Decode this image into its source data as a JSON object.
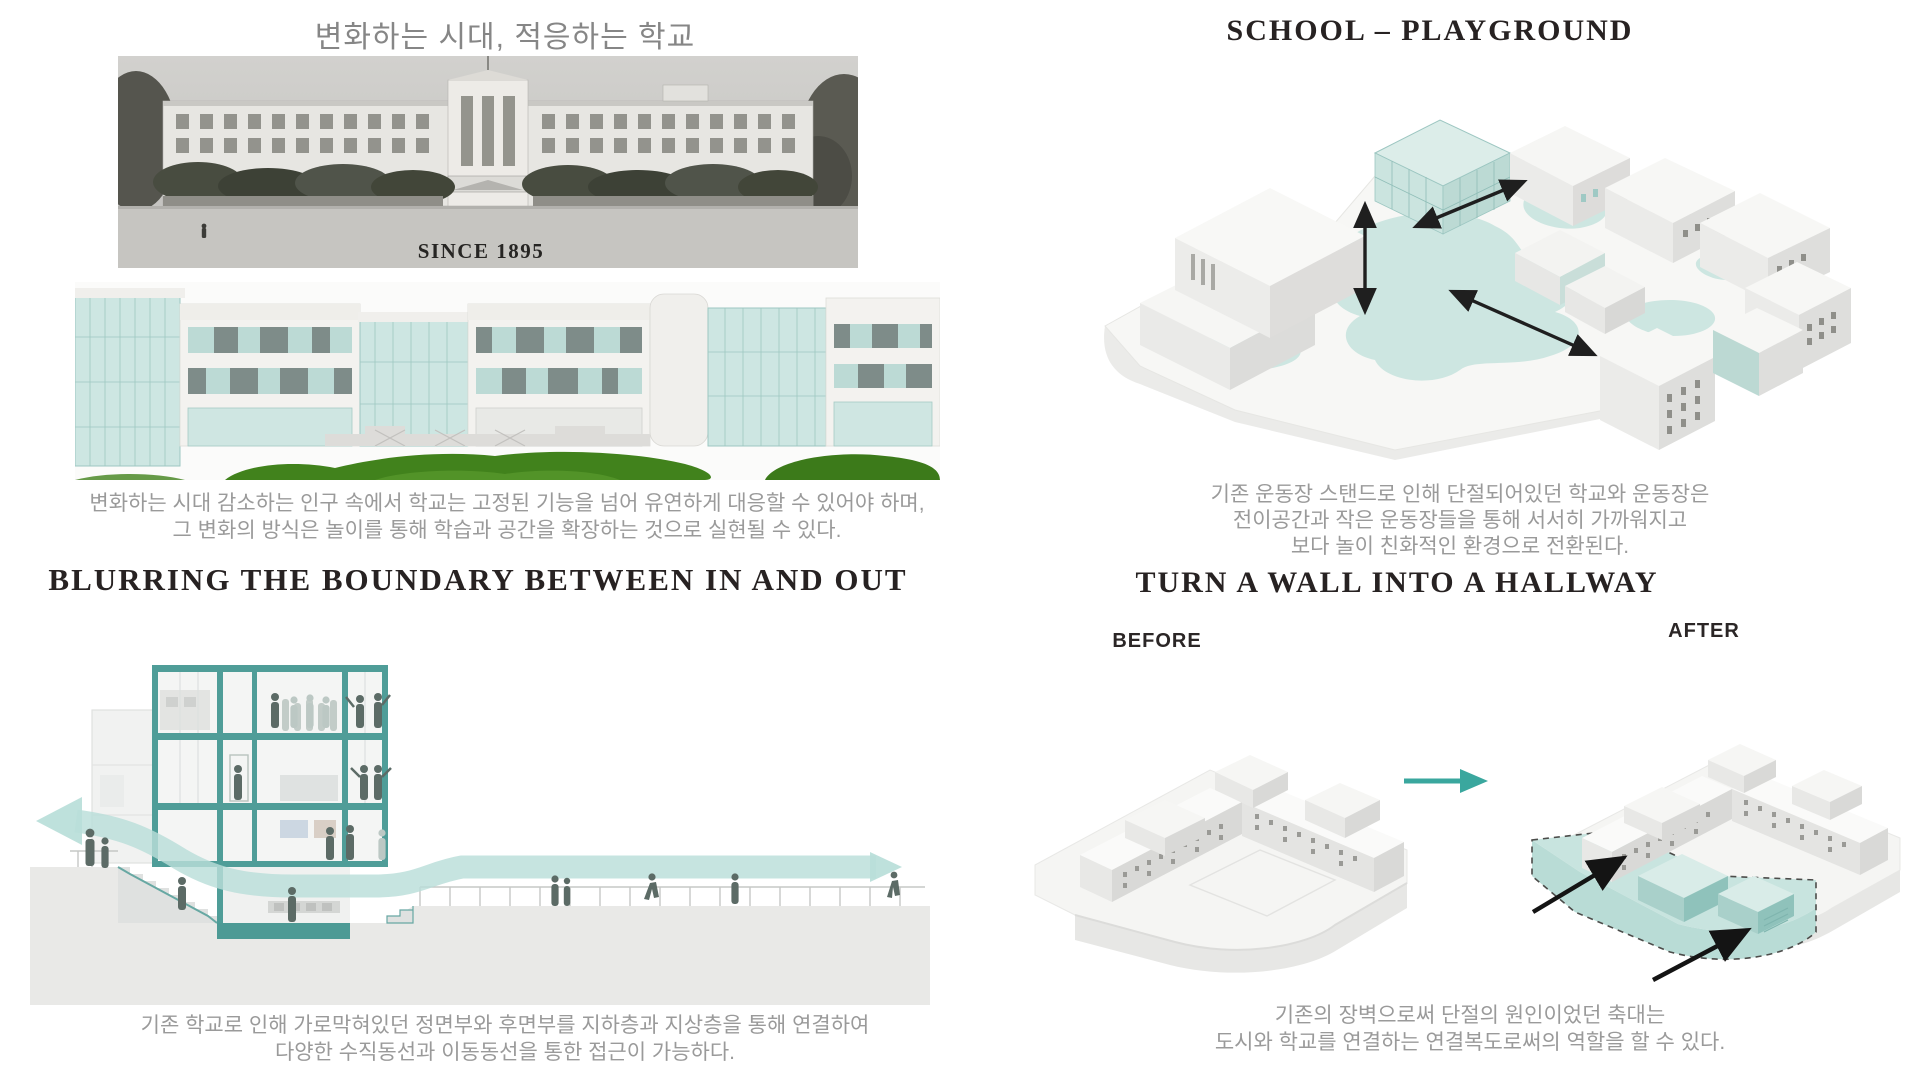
{
  "colors": {
    "teal_accent": "#4f9d98",
    "teal_glass": "#cde6e2",
    "teal_band": "#b9ded9",
    "teal_arrow": "#3aa79e",
    "green_lawn": "#3f7e1d",
    "dark_title": "#272222",
    "gray_text": "#9a9a9a"
  },
  "panels": {
    "adapt": {
      "title": "변화하는 시대, 적응하는 학교",
      "photo_label": "SINCE 1895",
      "caption": {
        "line1": "변화하는 시대 감소하는 인구 속에서 학교는 고정된 기능을 넘어 유연하게 대응할 수 있어야 하며,",
        "line2": "그 변화의 방식은 놀이를 통해 학습과 공간을 확장하는 것으로 실현될 수 있다."
      }
    },
    "school_playground": {
      "title": "SCHOOL – PLAYGROUND",
      "caption": {
        "line1": "기존 운동장 스탠드로 인해 단절되어있던 학교와 운동장은",
        "line2": "전이공간과 작은 운동장들을 통해 서서히 가까워지고",
        "line3": "보다 놀이 친화적인 환경으로 전환된다."
      }
    },
    "blurring": {
      "title": "BLURRING THE BOUNDARY BETWEEN IN AND OUT",
      "caption": {
        "line1": "기존 학교로 인해 가로막혀있던 정면부와 후면부를 지하층과 지상층을 통해 연결하여",
        "line2": "다양한 수직동선과 이동동선을 통한 접근이 가능하다."
      }
    },
    "wall_hallway": {
      "title": "TURN A WALL INTO A HALLWAY",
      "before_label": "BEFORE",
      "after_label": "AFTER",
      "caption": {
        "line1": "기존의 장벽으로써 단절의 원인이었던 축대는",
        "line2": "도시와 학교를 연결하는 연결복도로써의 역할을 할 수 있다."
      }
    }
  }
}
